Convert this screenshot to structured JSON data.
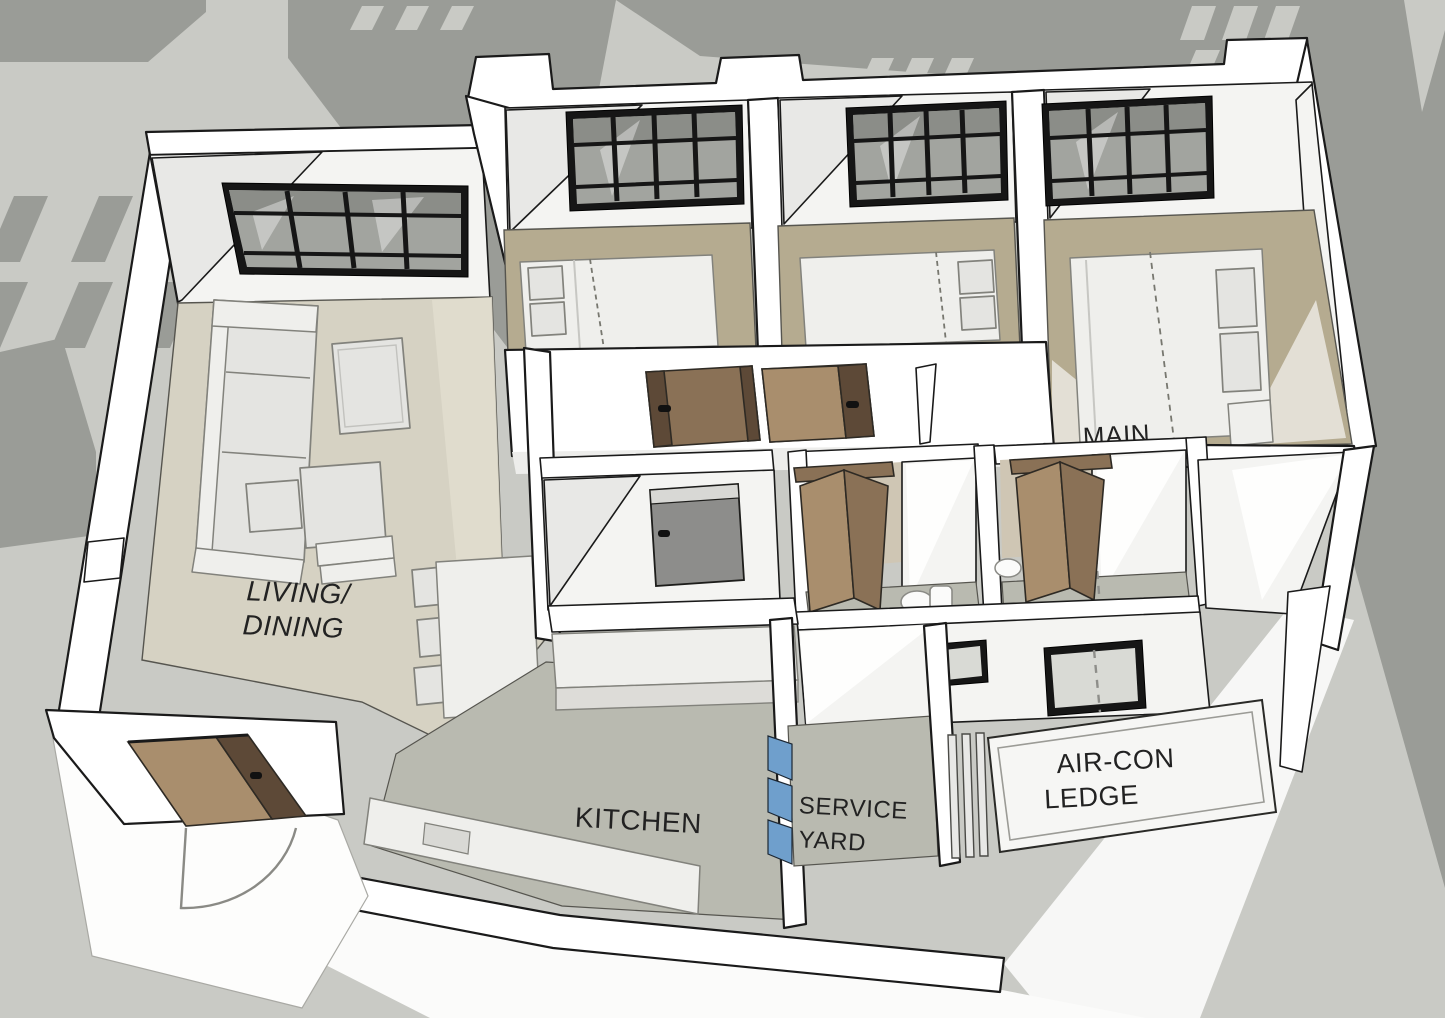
{
  "scene": {
    "description": "3D SketchUp-style floor plan of a 3-bedroom apartment viewed from above at an angle, white walls on a grey background with building shadow silhouettes",
    "labels": {
      "living_line1": "LIVING/",
      "living_line2": "DINING",
      "kitchen": "KITCHEN",
      "service_line1": "SERVICE",
      "service_line2": "YARD",
      "aircon_line1": "AIR-CON",
      "aircon_line2": "LEDGE",
      "main": "MAIN"
    },
    "rooms": [
      "Living/Dining",
      "Kitchen",
      "Service Yard",
      "Air-Con Ledge",
      "Main Bedroom",
      "Bedroom 2",
      "Bedroom 3",
      "Bathroom",
      "Master Bathroom",
      "Entrance"
    ]
  },
  "colors": {
    "background": "#c9cac5",
    "silhouette": "#9a9c97",
    "ground_white": "#fbfbfa",
    "wall": "#ffffff",
    "wall_shadow": "#e8e8e6",
    "outline": "#1a1a1a",
    "floor_living": "#d6d2c3",
    "floor_bedroom": "#b5ab90",
    "floor_wet": "#b9bab0",
    "window_frame": "#161616",
    "window_glass": "#a2a49f",
    "glass_dark": "#8b8d88",
    "wood_light": "#a98e6d",
    "wood_mid": "#8a7156",
    "wood_dark": "#5d4937",
    "door_gray": "#8d8d8b",
    "louvre_blue": "#6f9fcc",
    "furniture": "#e4e4e1",
    "furniture_outline": "#82827c",
    "text": "#222222"
  }
}
